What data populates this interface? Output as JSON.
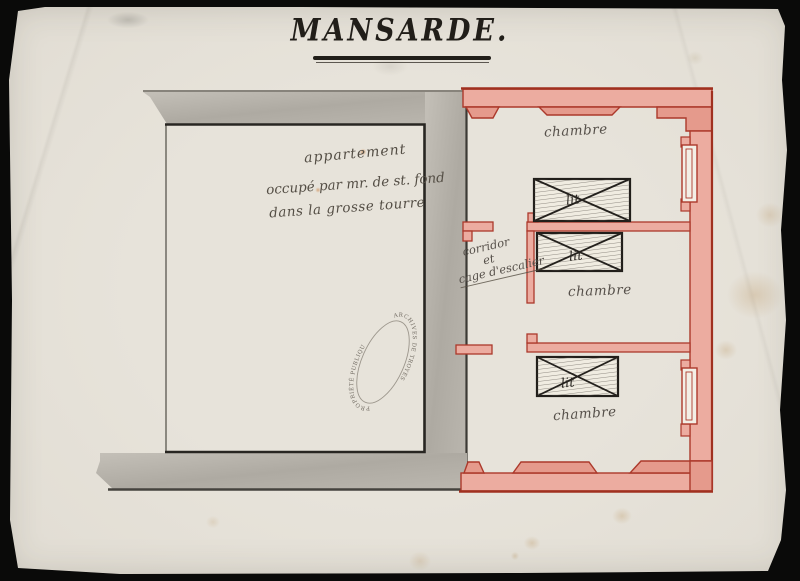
{
  "title": "MANSARDE.",
  "left_apartment": {
    "annotation": [
      "appartement",
      "occupé par mr. de st. fond",
      "dans la grosse tourre"
    ]
  },
  "corridor": {
    "lines": [
      "corridor",
      "et",
      "cage d'escalier"
    ]
  },
  "rooms": [
    {
      "label": "chambre",
      "bed": "lit"
    },
    {
      "label": "chambre",
      "bed": "lit"
    },
    {
      "label": "chambre",
      "bed": "lit"
    }
  ],
  "stamp": {
    "arc_top": "ARCHIVES DE TROYES",
    "arc_bottom": "PROPRIÉTÉ PUBLIQUE"
  },
  "colors": {
    "paper": "#e3dfd6",
    "background": "#0a0a09",
    "wall_red_line": "#ac392b",
    "wall_red_fill": "#ecaca0",
    "wall_gray_fill": "#b2aea6",
    "plan_ink": "#23201c",
    "writing_ink": "#544e45"
  }
}
